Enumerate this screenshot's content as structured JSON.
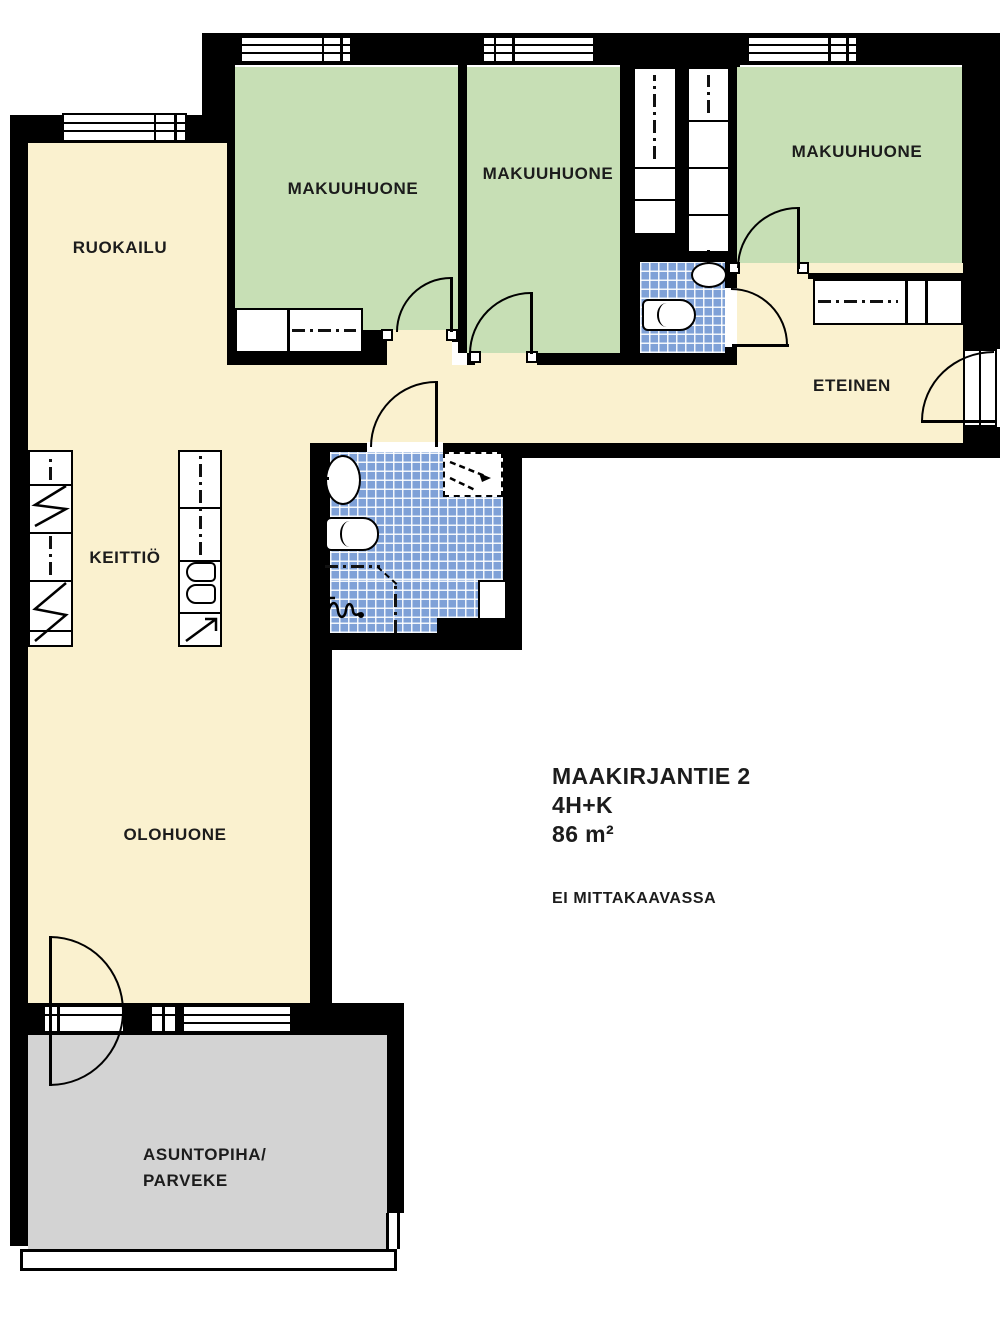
{
  "info": {
    "address": "MAAKIRJANTIE 2",
    "layout": "4H+K",
    "area": "86 m²",
    "note": "EI MITTAKAAVASSA"
  },
  "rooms": {
    "dining": "RUOKAILU",
    "bedroom1": "MAKUUHUONE",
    "bedroom2": "MAKUUHUONE",
    "bedroom3": "MAKUUHUONE",
    "hall": "ETEINEN",
    "kitchen": "KEITTIÖ",
    "living": "OLOHUONE",
    "balcony_line1": "ASUNTOPIHA/",
    "balcony_line2": "PARVEKE"
  },
  "colors": {
    "floor": "#FAF1CF",
    "bedroom": "#C7DFB5",
    "tile": "#7FA1D7",
    "balcony": "#D3D3D3",
    "wall": "#000000",
    "text": "#1C1C1C"
  }
}
